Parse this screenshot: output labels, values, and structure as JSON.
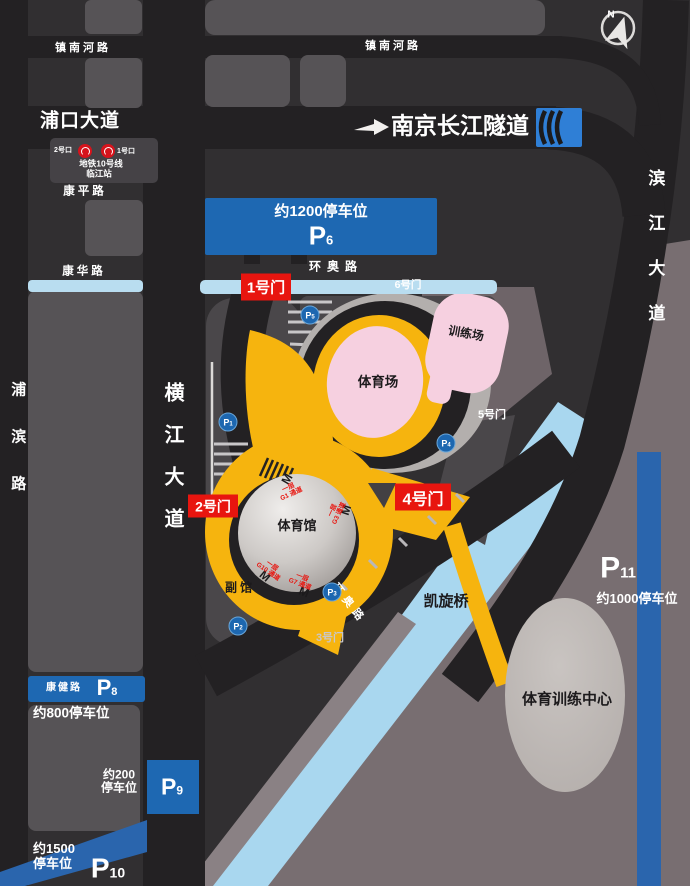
{
  "compass": {
    "north": "N"
  },
  "roads": {
    "zhennanhe": "镇南河路",
    "pukou": "浦口大道",
    "kangping": "康平路",
    "kanghua": "康华路",
    "pubin": "浦滨路",
    "hengjiang": "横江大道",
    "binjiang": "滨江大道",
    "huanao": "环奥路",
    "kangjian": "康健路",
    "kaixuan_bridge": "凯旋桥",
    "tunnel": "南京长江隧道"
  },
  "metro": {
    "exit2": "2号口",
    "exit1": "1号口",
    "line": "地铁10号线",
    "station": "临江站"
  },
  "gates": {
    "gate1": "1号门",
    "gate2": "2号门",
    "gate3": "3号门",
    "gate4": "4号门",
    "gate5": "5号门",
    "gate6": "6号门"
  },
  "venues": {
    "stadium": "体育场",
    "gymnasium": "体育馆",
    "training_field": "训练场",
    "annex": "副馆",
    "training_center": "体育训练中心"
  },
  "parking_lots": {
    "p6": {
      "p": "P",
      "num": "6",
      "capacity": "约1200停车位"
    },
    "p8": {
      "p": "P",
      "num": "8",
      "capacity": "约800停车位",
      "road": "康健路"
    },
    "p9": {
      "p": "P",
      "num": "9",
      "capacity_line1": "约200",
      "capacity_line2": "停车位"
    },
    "p10": {
      "p": "P",
      "num": "10",
      "capacity_line1": "约1500",
      "capacity_line2": "停车位"
    },
    "p11": {
      "p": "P",
      "num": "11",
      "capacity": "约1000停车位"
    }
  },
  "parking_markers": [
    {
      "p": "P",
      "num": "1"
    },
    {
      "p": "P",
      "num": "2"
    },
    {
      "p": "P",
      "num": "3"
    },
    {
      "p": "P",
      "num": "4"
    },
    {
      "p": "P",
      "num": "5"
    }
  ],
  "passages": [
    {
      "floor": "一层",
      "gate": "G1 通道"
    },
    {
      "floor": "一层",
      "gate": "G3 通道"
    },
    {
      "floor": "一层",
      "gate": "G10 通道"
    },
    {
      "floor": "一层",
      "gate": "G7 通道"
    }
  ],
  "metro_entrance_marks": [
    "M",
    "M",
    "M",
    "M"
  ],
  "colors": {
    "parking_blue": "#1e68b2",
    "strip_blue": "#2a65ad",
    "tunnel_blue": "#2f7fd6",
    "gate_red": "#e8150f",
    "path_yellow": "#f6b40e",
    "venue_pink": "#f6d0e0",
    "river_blue": "#a9d7ef",
    "band_blue": "#b9ddf0"
  }
}
